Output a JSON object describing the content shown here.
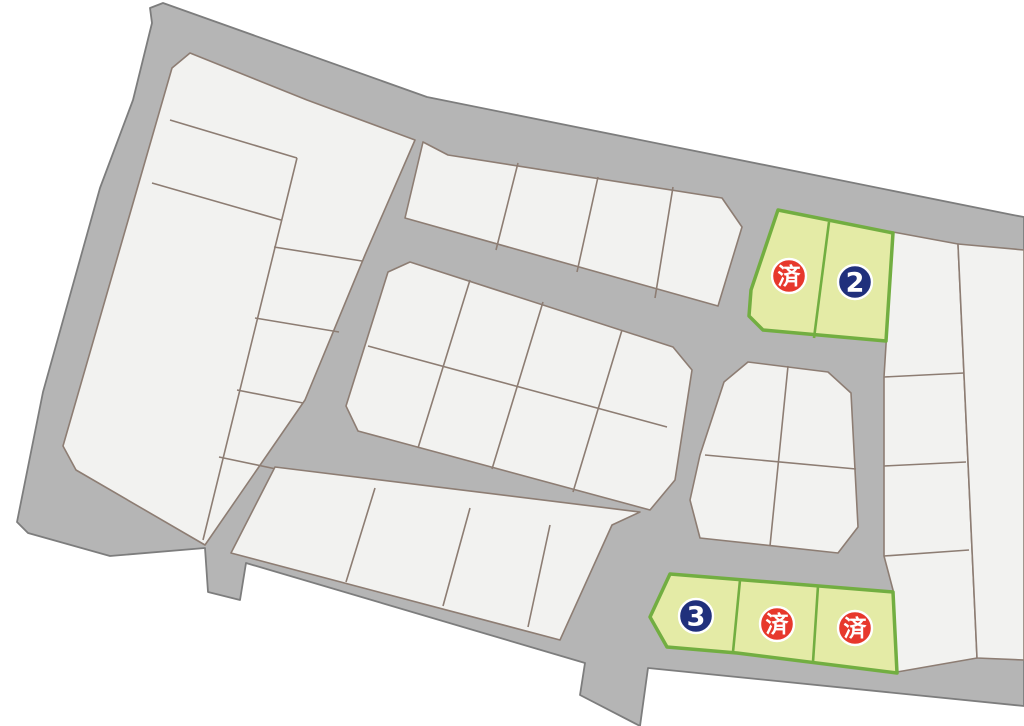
{
  "map": {
    "kind": "land-subdivision-lot-map",
    "colors": {
      "road": "#b5b5b5",
      "road_border": "#7d7d7d",
      "lot_fill": "#f2f2f0",
      "lot_border": "#8d7d73",
      "highlight_fill": "#e4eba6",
      "highlight_border": "#72ae41",
      "sold": "#e7382c",
      "available": "#20307c",
      "marker_text": "#ffffff"
    },
    "markers": [
      {
        "lot": "north-left",
        "label": "済",
        "status": "sold",
        "x": 789,
        "y": 276
      },
      {
        "lot": "north-right",
        "label": "2",
        "status": "available",
        "x": 855,
        "y": 282
      },
      {
        "lot": "south-left",
        "label": "3",
        "status": "available",
        "x": 696,
        "y": 616
      },
      {
        "lot": "south-middle",
        "label": "済",
        "status": "sold",
        "x": 777,
        "y": 624
      },
      {
        "lot": "south-right",
        "label": "済",
        "status": "sold",
        "x": 855,
        "y": 628
      }
    ]
  }
}
